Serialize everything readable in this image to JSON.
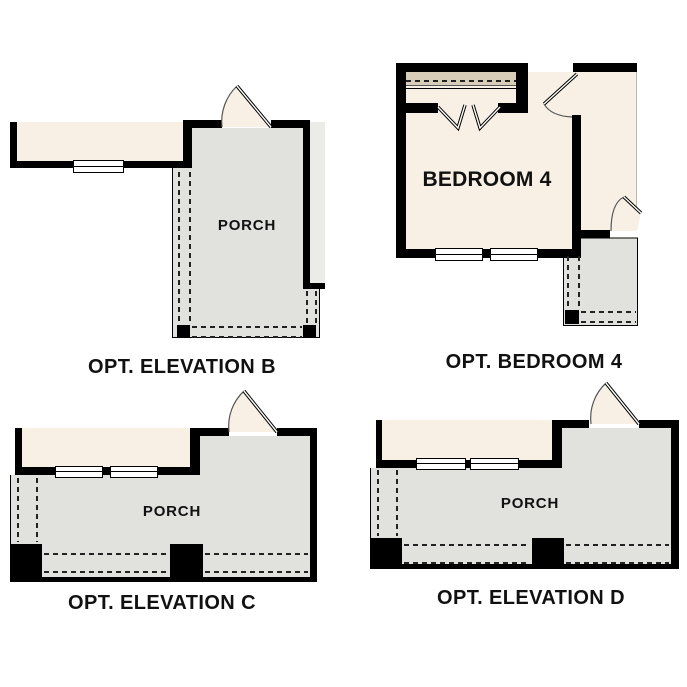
{
  "colors": {
    "wall": "#000000",
    "interior_cream": "#f8f0e5",
    "porch_gray": "#e1e1de",
    "patio_gray": "#ebebe8",
    "shelf_tan": "#d8cdb9",
    "line": "#222222",
    "label": "#111111"
  },
  "panels": {
    "elevation_b": {
      "caption": "OPT. ELEVATION B",
      "room_label": "PORCH"
    },
    "bedroom_4": {
      "caption": "OPT. BEDROOM 4",
      "room_label": "BEDROOM 4"
    },
    "elevation_c": {
      "caption": "OPT. ELEVATION C",
      "room_label": "PORCH"
    },
    "elevation_d": {
      "caption": "OPT. ELEVATION D",
      "room_label": "PORCH"
    }
  }
}
